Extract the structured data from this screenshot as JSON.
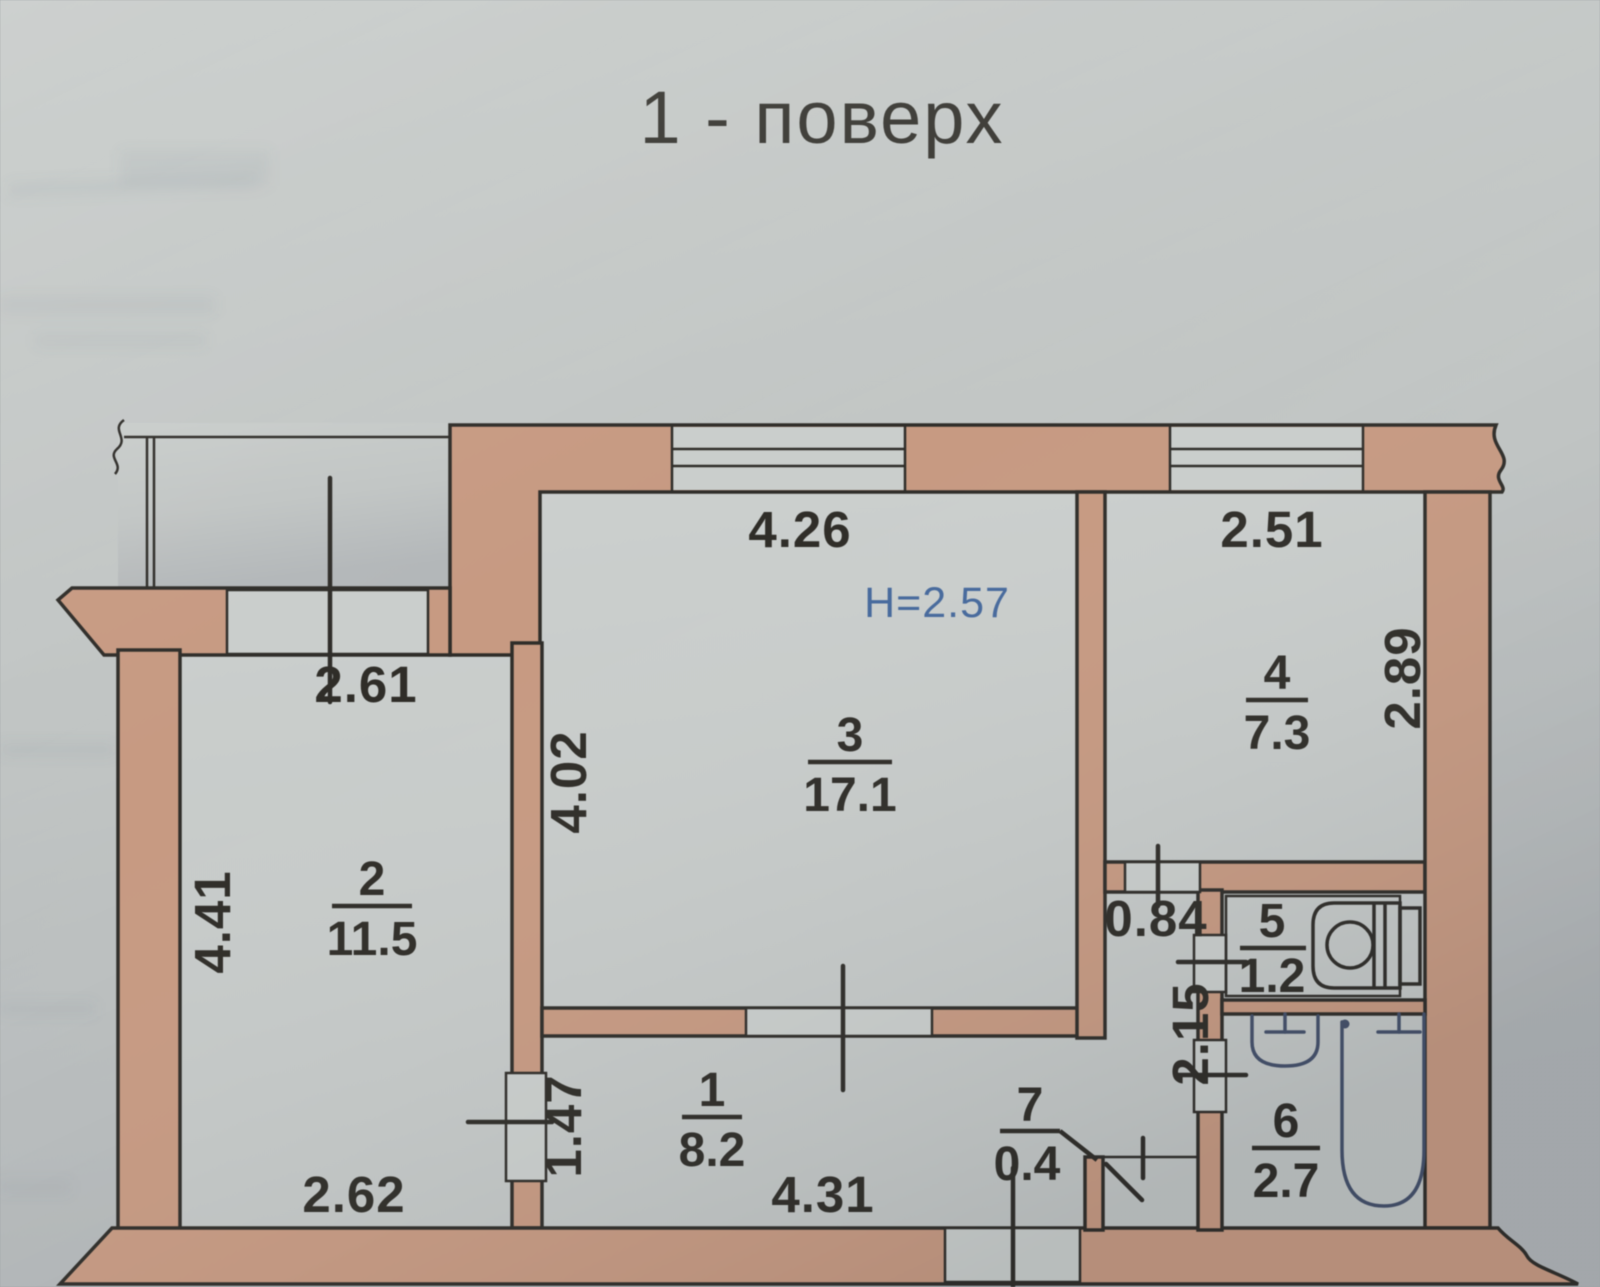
{
  "title": "1 - поверх",
  "plan": {
    "height_label": "H=2.57",
    "rooms": [
      {
        "number": "1",
        "area": "8.2"
      },
      {
        "number": "2",
        "area": "11.5"
      },
      {
        "number": "3",
        "area": "17.1"
      },
      {
        "number": "4",
        "area": "7.3"
      },
      {
        "number": "5",
        "area": "1.2"
      },
      {
        "number": "6",
        "area": "2.7"
      },
      {
        "number": "7",
        "area": "0.4"
      }
    ],
    "dimensions": {
      "room3_window_width": "4.26",
      "room4_window_width": "2.51",
      "room2_top_opening": "2.61",
      "room3_depth": "4.02",
      "room2_depth": "4.41",
      "room4_depth": "2.89",
      "hall_width": "0.84",
      "bath_depth": "2.15",
      "room2_door_width": "1.47",
      "room2_width": "2.62",
      "corridor_width": "4.31"
    },
    "colors": {
      "paper": "#c2c6c4",
      "room": "#cacecc",
      "wall": "#c79a82",
      "line": "#2f2d29",
      "text": "#2f2d28",
      "blue": "#46699c",
      "fixture": "#44506a"
    }
  }
}
